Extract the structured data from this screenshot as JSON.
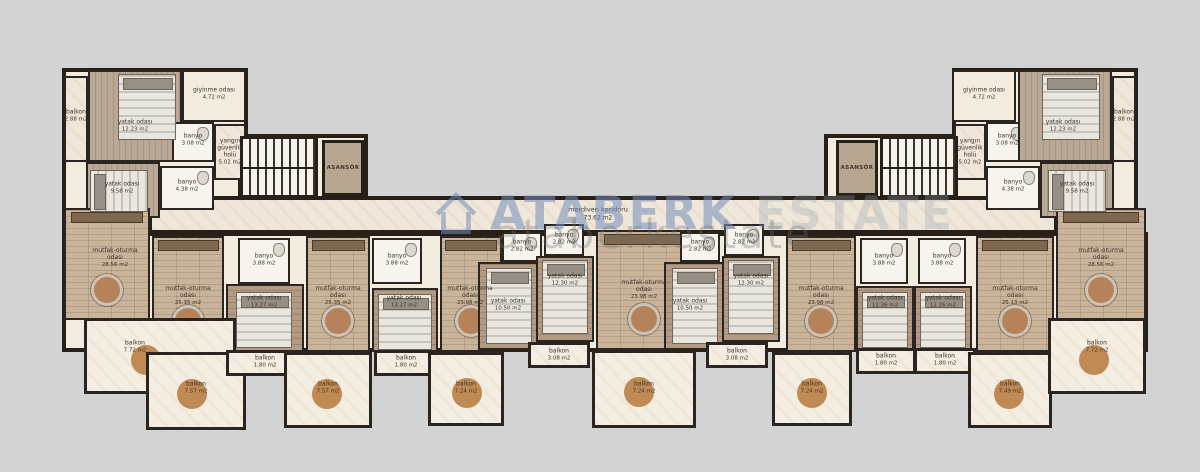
{
  "background_color": "#d3d3d3",
  "watermark": {
    "brand": "ATABERK",
    "brand_faded": "ESTATE",
    "url_text": "ataberkestate",
    "brand_color": "#748cbe",
    "house_icon": "house-outline-icon"
  },
  "corridor": {
    "name": "merdiven koridoru",
    "area": "73.62 m2"
  },
  "elevators": [
    {
      "label": "ASANSÖR"
    },
    {
      "label": "ASANSÖR"
    }
  ],
  "rooms": [
    {
      "name": "balkon",
      "area": "2.88 m2",
      "x": 76,
      "y": 116,
      "w": 26
    },
    {
      "name": "yatak odası",
      "area": "12.23 m2",
      "x": 135,
      "y": 126
    },
    {
      "name": "giyinme odası",
      "area": "4.72 m2",
      "x": 214,
      "y": 94
    },
    {
      "name": "banyo",
      "area": "3.08 m2",
      "x": 193,
      "y": 140
    },
    {
      "name": "yangın güvenlik holü",
      "area": "5.02 m2",
      "x": 230,
      "y": 152,
      "w": 30
    },
    {
      "name": "yatak odası",
      "area": "9.58 m2",
      "x": 122,
      "y": 188
    },
    {
      "name": "banyo",
      "area": "4.38 m2",
      "x": 187,
      "y": 186
    },
    {
      "name": "giyinme odası",
      "area": "4.72 m2",
      "x": 984,
      "y": 94
    },
    {
      "name": "banyo",
      "area": "3.08 m2",
      "x": 1007,
      "y": 140
    },
    {
      "name": "yatak odası",
      "area": "12.23 m2",
      "x": 1063,
      "y": 126
    },
    {
      "name": "balkon",
      "area": "2.88 m2",
      "x": 1124,
      "y": 116,
      "w": 26
    },
    {
      "name": "yangın güvenlik holü",
      "area": "5.02 m2",
      "x": 970,
      "y": 152,
      "w": 30
    },
    {
      "name": "yatak odası",
      "area": "9.58 m2",
      "x": 1077,
      "y": 188
    },
    {
      "name": "banyo",
      "area": "4.38 m2",
      "x": 1013,
      "y": 186
    },
    {
      "name": "mutfak-oturma odası",
      "area": "28.56 m2",
      "x": 115,
      "y": 258
    },
    {
      "name": "balkon",
      "area": "7.72 m2",
      "x": 135,
      "y": 347
    },
    {
      "name": "mutfak-oturma odası",
      "area": "25.35 m2",
      "x": 188,
      "y": 296
    },
    {
      "name": "balkon",
      "area": "7.57 m2",
      "x": 196,
      "y": 388
    },
    {
      "name": "banyo",
      "area": "3.88 m2",
      "x": 264,
      "y": 260
    },
    {
      "name": "yatak odası",
      "area": "13.27 m2",
      "x": 264,
      "y": 302
    },
    {
      "name": "balkon",
      "area": "1.80 m2",
      "x": 265,
      "y": 362
    },
    {
      "name": "mutfak-oturma odası",
      "area": "25.35 m2",
      "x": 338,
      "y": 296
    },
    {
      "name": "balkon",
      "area": "7.57 m2",
      "x": 328,
      "y": 388
    },
    {
      "name": "banyo",
      "area": "3.88 m2",
      "x": 397,
      "y": 260
    },
    {
      "name": "yatak odası",
      "area": "13.27 m2",
      "x": 404,
      "y": 302
    },
    {
      "name": "balkon",
      "area": "1.80 m2",
      "x": 406,
      "y": 362
    },
    {
      "name": "mutfak-oturma odası",
      "area": "23.98 m2",
      "x": 470,
      "y": 296
    },
    {
      "name": "balkon",
      "area": "7.24 m2",
      "x": 466,
      "y": 388
    },
    {
      "name": "banyo",
      "area": "2.82 m2",
      "x": 522,
      "y": 246
    },
    {
      "name": "yatak odası",
      "area": "10.50 m2",
      "x": 508,
      "y": 305
    },
    {
      "name": "banyo",
      "area": "2.82 m2",
      "x": 564,
      "y": 239
    },
    {
      "name": "yatak odası",
      "area": "12.30 m2",
      "x": 565,
      "y": 280
    },
    {
      "name": "balkon",
      "area": "3.08 m2",
      "x": 559,
      "y": 355,
      "w": 32
    },
    {
      "name": "mutfak-oturma odası",
      "area": "23.98 m2",
      "x": 644,
      "y": 290
    },
    {
      "name": "balkon",
      "area": "7.24 m2",
      "x": 644,
      "y": 388
    },
    {
      "name": "banyo",
      "area": "2.82 m2",
      "x": 700,
      "y": 246
    },
    {
      "name": "yatak odası",
      "area": "10.50 m2",
      "x": 690,
      "y": 305
    },
    {
      "name": "banyo",
      "area": "2.82 m2",
      "x": 744,
      "y": 239
    },
    {
      "name": "yatak odası",
      "area": "12.30 m2",
      "x": 751,
      "y": 280
    },
    {
      "name": "balkon",
      "area": "3.08 m2",
      "x": 737,
      "y": 355,
      "w": 32
    },
    {
      "name": "mutfak-oturma odası",
      "area": "23.98 m2",
      "x": 821,
      "y": 296
    },
    {
      "name": "balkon",
      "area": "7.24 m2",
      "x": 812,
      "y": 388
    },
    {
      "name": "banyo",
      "area": "3.88 m2",
      "x": 884,
      "y": 260
    },
    {
      "name": "yatak odası",
      "area": "12.26 m2",
      "x": 885,
      "y": 302
    },
    {
      "name": "balkon",
      "area": "1.80 m2",
      "x": 886,
      "y": 360
    },
    {
      "name": "banyo",
      "area": "3.88 m2",
      "x": 942,
      "y": 260
    },
    {
      "name": "yatak odası",
      "area": "12.26 m2",
      "x": 943,
      "y": 302
    },
    {
      "name": "balkon",
      "area": "1.80 m2",
      "x": 945,
      "y": 360
    },
    {
      "name": "mutfak-oturma odası",
      "area": "25.13 m2",
      "x": 1015,
      "y": 296
    },
    {
      "name": "balkon",
      "area": "7.49 m2",
      "x": 1010,
      "y": 388
    },
    {
      "name": "mutfak-oturma odası",
      "area": "28.56 m2",
      "x": 1101,
      "y": 258
    },
    {
      "name": "balkon",
      "area": "7.72 m2",
      "x": 1097,
      "y": 347
    }
  ]
}
